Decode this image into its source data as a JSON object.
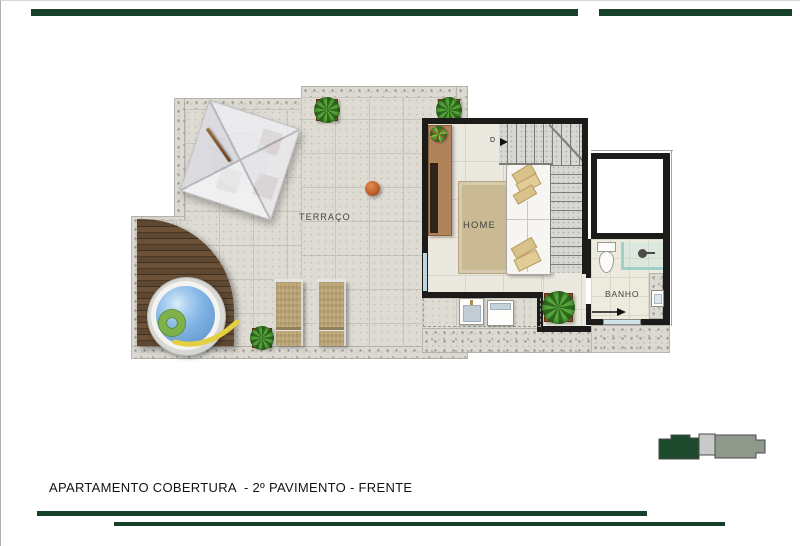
{
  "theme": {
    "rule_green": "#16402a",
    "wall": "#1b1b19",
    "terrace_tile": "#dedbd3",
    "home_tile": "#ebe8df",
    "granite": "#dbd9d1",
    "water_blue": "#84b5e0",
    "rug_tan": "#c9ba93",
    "locator_green": "#1d4a2c",
    "locator_light": "#c9c9c9",
    "locator_gray": "#8e998c"
  },
  "plan": {
    "labels": {
      "terrace": "TERRAÇO",
      "home": "HOME",
      "bath": "BANHO",
      "door": "D"
    }
  },
  "footer": {
    "title": "APARTAMENTO COBERTURA  - 2º PAVIMENTO - FRENTE"
  }
}
